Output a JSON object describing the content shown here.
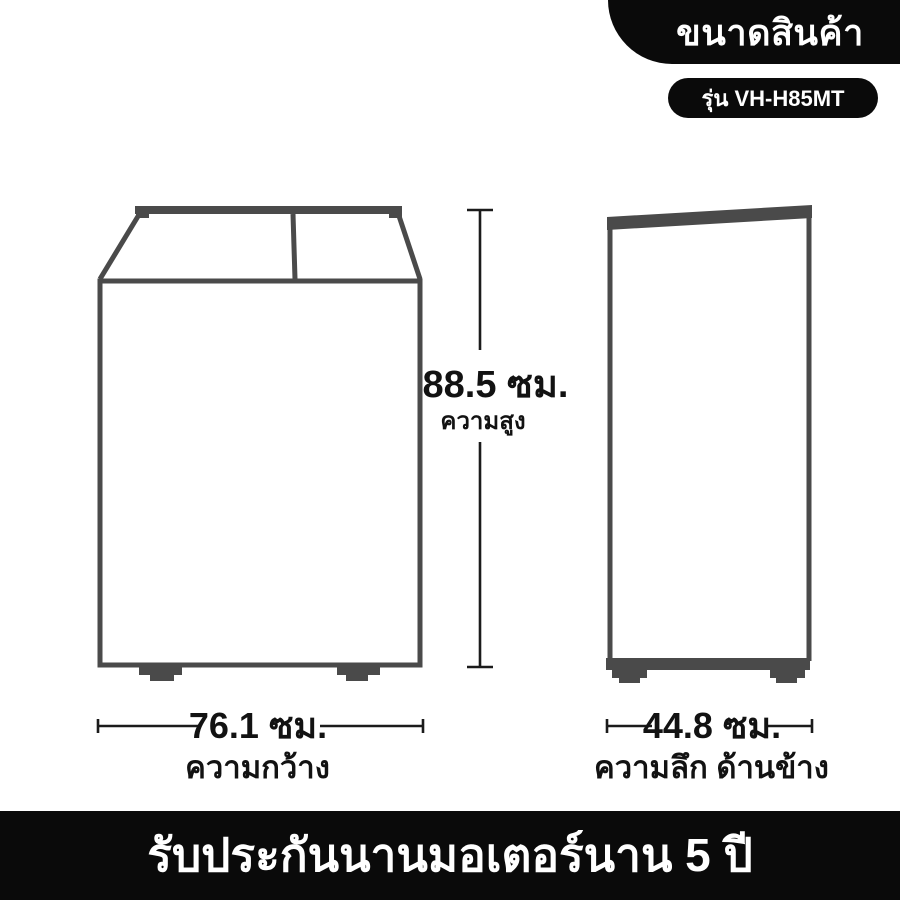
{
  "header": {
    "title": "ขนาดสินค้า",
    "model": "รุ่น VH-H85MT"
  },
  "dimensions": {
    "height": {
      "value": "88.5 ซม.",
      "label": "ความสูง"
    },
    "width": {
      "value": "76.1 ซม.",
      "label": "ความกว้าง"
    },
    "depth": {
      "value": "44.8 ซม.",
      "label": "ความลึก ด้านข้าง"
    }
  },
  "footer": {
    "warranty": "รับประกันนานมอเตอร์นาน 5 ปี"
  },
  "colors": {
    "outline_gray": "#4a4a4a",
    "dimension_black": "#1b1b1b",
    "badge_black": "#0a0a0a",
    "text_black": "#121212",
    "background": "#ffffff"
  }
}
